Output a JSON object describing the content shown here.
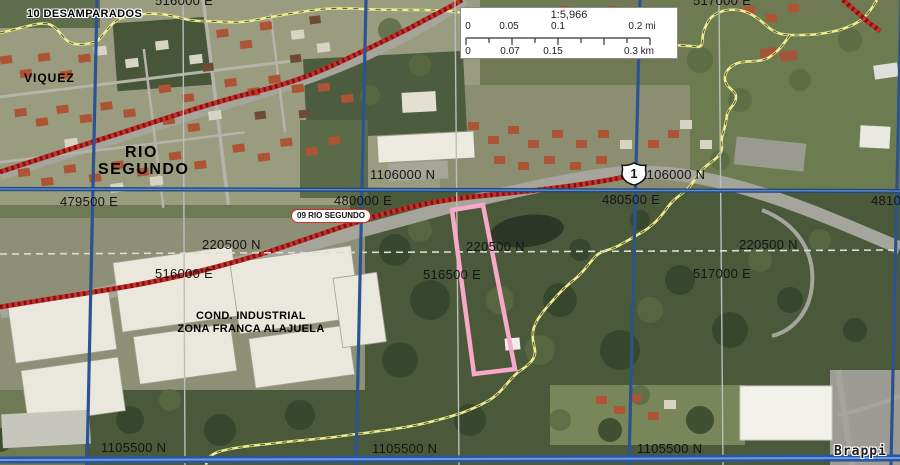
{
  "map": {
    "labels": {
      "desamparados": "10 DESAMPARADOS",
      "viquez": "VIQUEZ",
      "rio_segundo": [
        "RIO",
        "SEGUNDO"
      ],
      "cond_industrial": [
        "COND. INDUSTRIAL",
        "ZONA FRANCA ALAJUELA"
      ],
      "road_09": "09 RIO SEGUNDO",
      "route_number": "1",
      "watermark": "Brappi"
    },
    "grid_crtm05": {
      "color": "#2b5390",
      "east_labels": [
        "479500 E",
        "480000 E",
        "480500 E",
        "481000 E"
      ],
      "north_labels": [
        "1106000 N",
        "1105500 N"
      ]
    },
    "grid_lambert": {
      "color": "#bdbdb9",
      "east_labels": [
        "516000 E",
        "516500 E",
        "517000 E"
      ],
      "north_label": "220500 N"
    },
    "scalebar": {
      "ratio": "1:5,966",
      "miles": [
        "0",
        "0.05",
        "0.1",
        "0.2 mi"
      ],
      "km": [
        "0",
        "0.07",
        "0.15",
        "0.3 km"
      ]
    },
    "parcel": {
      "outline_color": "#f8a8c8"
    },
    "boundary": {
      "color": "#eeee8e"
    },
    "highway": {
      "color": "#c43129"
    }
  }
}
